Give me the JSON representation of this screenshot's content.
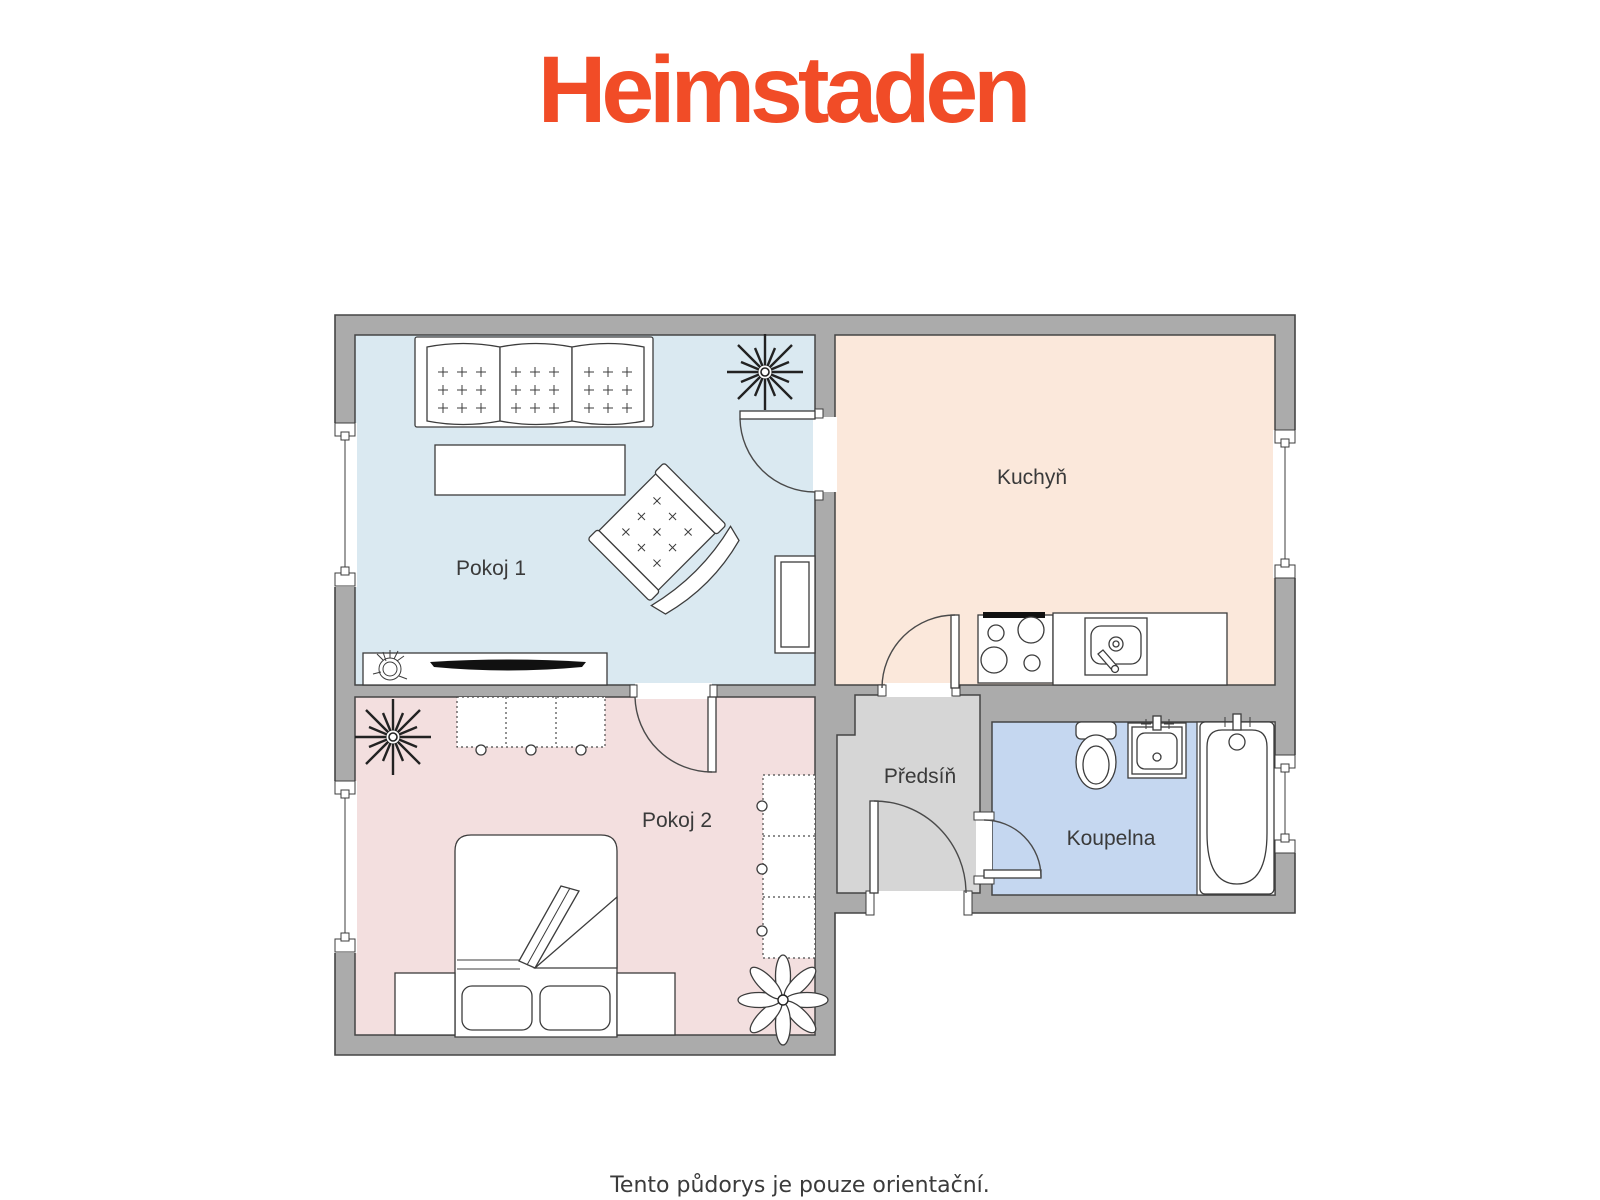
{
  "logo": {
    "text": "Heimstaden",
    "color": "#F14C27"
  },
  "plan": {
    "rooms": [
      {
        "label": "Pokoj 1",
        "fill": "#DAE9F1"
      },
      {
        "label": "Kuchyň",
        "fill": "#FBE8DB"
      },
      {
        "label": "Pokoj 2",
        "fill": "#F3DFDF"
      },
      {
        "label": "Předsíň",
        "fill": "#D6D6D6"
      },
      {
        "label": "Koupelna",
        "fill": "#C5D7F0"
      }
    ],
    "wall_fill": "#ABABAB",
    "outline_color": "#454545",
    "label_color": "#3A3A3A"
  },
  "footer": {
    "note": "Tento půdorys je pouze orientační."
  }
}
